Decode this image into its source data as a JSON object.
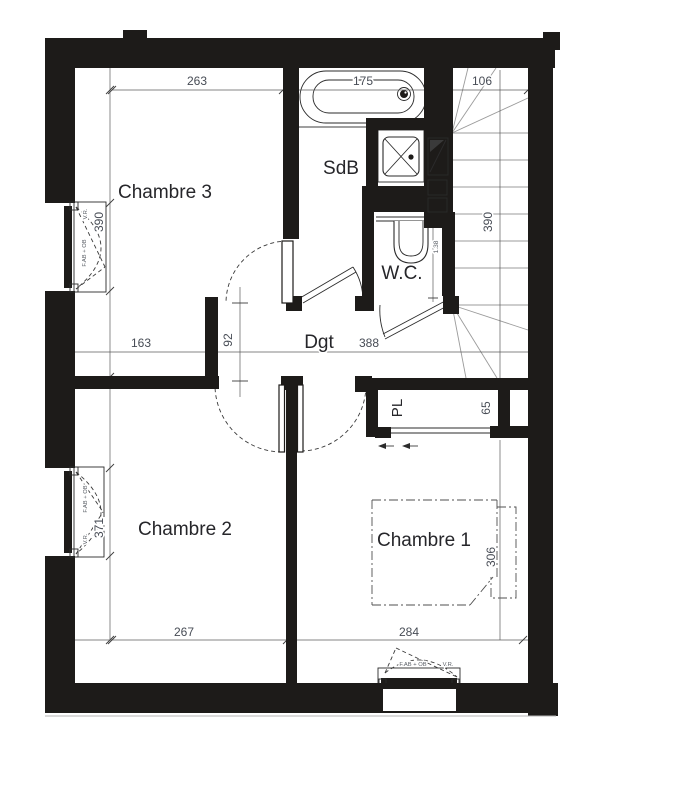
{
  "rooms": {
    "chambre3": "Chambre 3",
    "sdb": "SdB",
    "wc": "W.C.",
    "dgt": "Dgt",
    "pl": "PL",
    "chambre2": "Chambre 2",
    "chambre1": "Chambre 1"
  },
  "dims": {
    "ch3_width": "263",
    "bath": "175",
    "stairs_width": "106",
    "ch3_height": "390",
    "stairs_height": "390",
    "dgt_left": "163",
    "dgt_door": "92",
    "dgt_length": "388",
    "pl_depth": "65",
    "ch2_height": "371",
    "ch1_height": "306",
    "ch2_width": "267",
    "ch1_width": "284",
    "wc_inner": "1.38"
  },
  "windows": {
    "w1_shutter": "V.R.",
    "w1_type": "F.AB + OB",
    "w2_type": "F.AB + OB",
    "w2_shutter": "V.R.",
    "w3_type": "F.AB + OB",
    "w3_shutter": "V.R."
  },
  "colors": {
    "wall": "#1d1b19",
    "dim_text": "#474c55",
    "room_text": "#26262a",
    "stair_lines": "#9b9b9b"
  }
}
